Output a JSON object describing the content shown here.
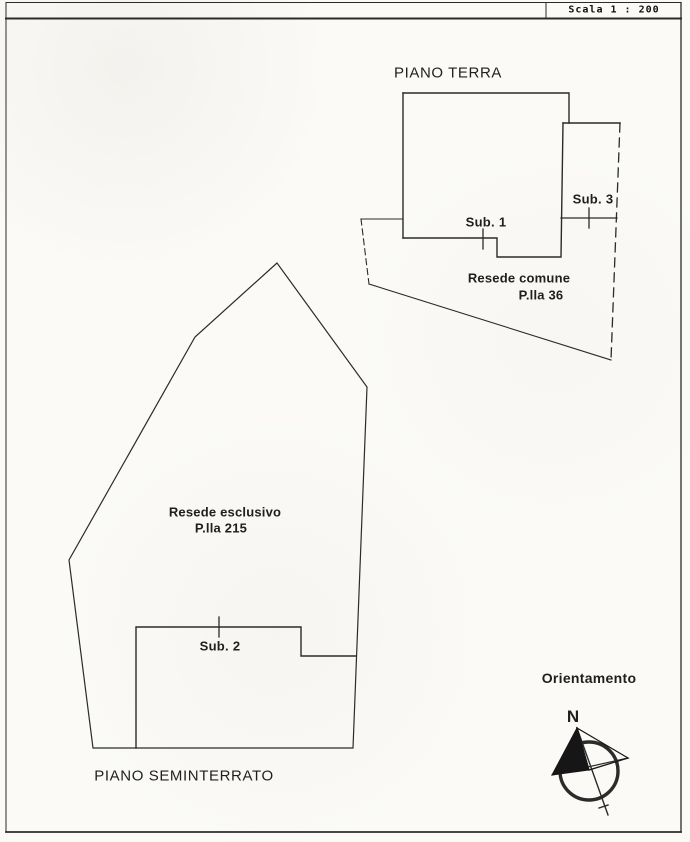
{
  "scale_box": {
    "label": "Scala 1 : 200"
  },
  "piano_terra": {
    "title": "PIANO TERRA",
    "sub1_label": "Sub. 1",
    "sub3_label": "Sub. 3",
    "resede_line1": "Resede comune",
    "resede_line2": "P.lla 36"
  },
  "piano_seminterrato": {
    "title": "PIANO SEMINTERRATO",
    "sub2_label": "Sub. 2",
    "resede_line1": "Resede esclusivo",
    "resede_line2": "P.lla 215"
  },
  "compass": {
    "title": "Orientamento",
    "north_label": "N"
  },
  "colors": {
    "ink": "#2b2b2b",
    "paper": "#fbfaf7"
  }
}
